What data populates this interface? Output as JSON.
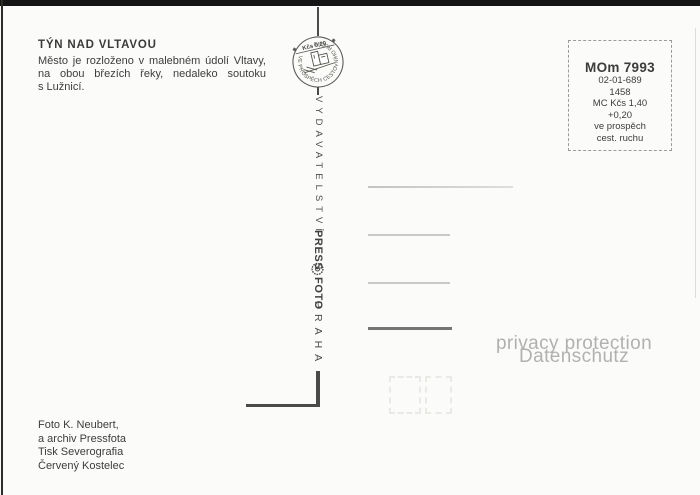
{
  "header": {
    "title": "TÝN NAD VLTAVOU",
    "description": [
      "Město je rozloženo v malebném údolí Vltavy,",
      "na obou březích řeky, nedaleko soutoku",
      "s Lužnicí."
    ]
  },
  "emblem": {
    "value_text": "Kčs 0,20",
    "ring_text": "VE PROSPĚCH CESTOVNÍHO RUCHU"
  },
  "publisher": {
    "word1": "VYDAVATELSTVÍ",
    "word2": "PRESS",
    "word3": "FOTO",
    "word4": "PRAHA"
  },
  "stamp_box": {
    "code": "MOm 7993",
    "lines": [
      "02-01-689",
      "1458",
      "MC Kčs 1,40",
      "+0,20",
      "ve prospěch",
      "cest. ruchu"
    ]
  },
  "watermark": {
    "line1": "privacy protection",
    "line2": "Datenschutz"
  },
  "credits": [
    "Foto K. Neubert,",
    "a archiv Pressfota",
    "Tisk Severografia",
    "Červený Kostelec"
  ],
  "colors": {
    "paper": "#fbfbf9",
    "ink": "#3e3e3e",
    "scan_border": "#151515",
    "divider": "#4a4a48",
    "watermark": "#b1b1b0",
    "address_line": "#c9c9c7",
    "address_line_dark": "#757571"
  }
}
